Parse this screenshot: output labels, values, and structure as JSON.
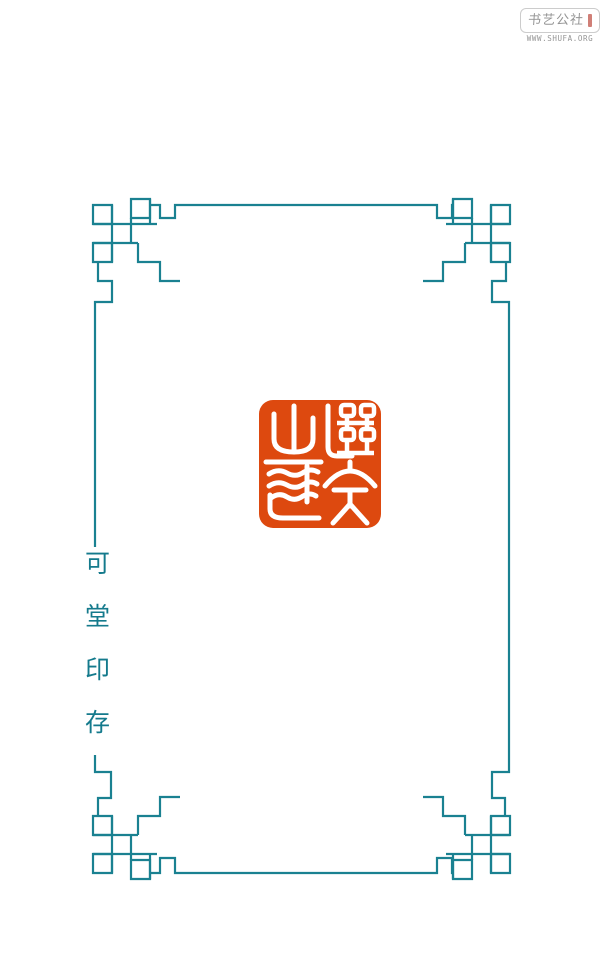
{
  "page": {
    "width": 605,
    "height": 964,
    "background": "#ffffff"
  },
  "watermark": {
    "site_name": "书艺公社",
    "site_url": "WWW.SHUFA.ORG",
    "box_border_color": "#cccccc",
    "text_color": "#949494",
    "red_mark_color": "#c0544a"
  },
  "frame": {
    "color": "#1a8191",
    "style": "chinese-fretwork-border"
  },
  "title": {
    "text": "可堂印存",
    "chars": [
      "可",
      "堂",
      "印",
      "存"
    ],
    "color": "#147a8c",
    "orientation": "vertical"
  },
  "seal": {
    "body_color": "#dd490f",
    "glyph_color": "#ffffff",
    "shape": "rounded-square",
    "description": "vermillion seal impression with white seal-script characters"
  }
}
